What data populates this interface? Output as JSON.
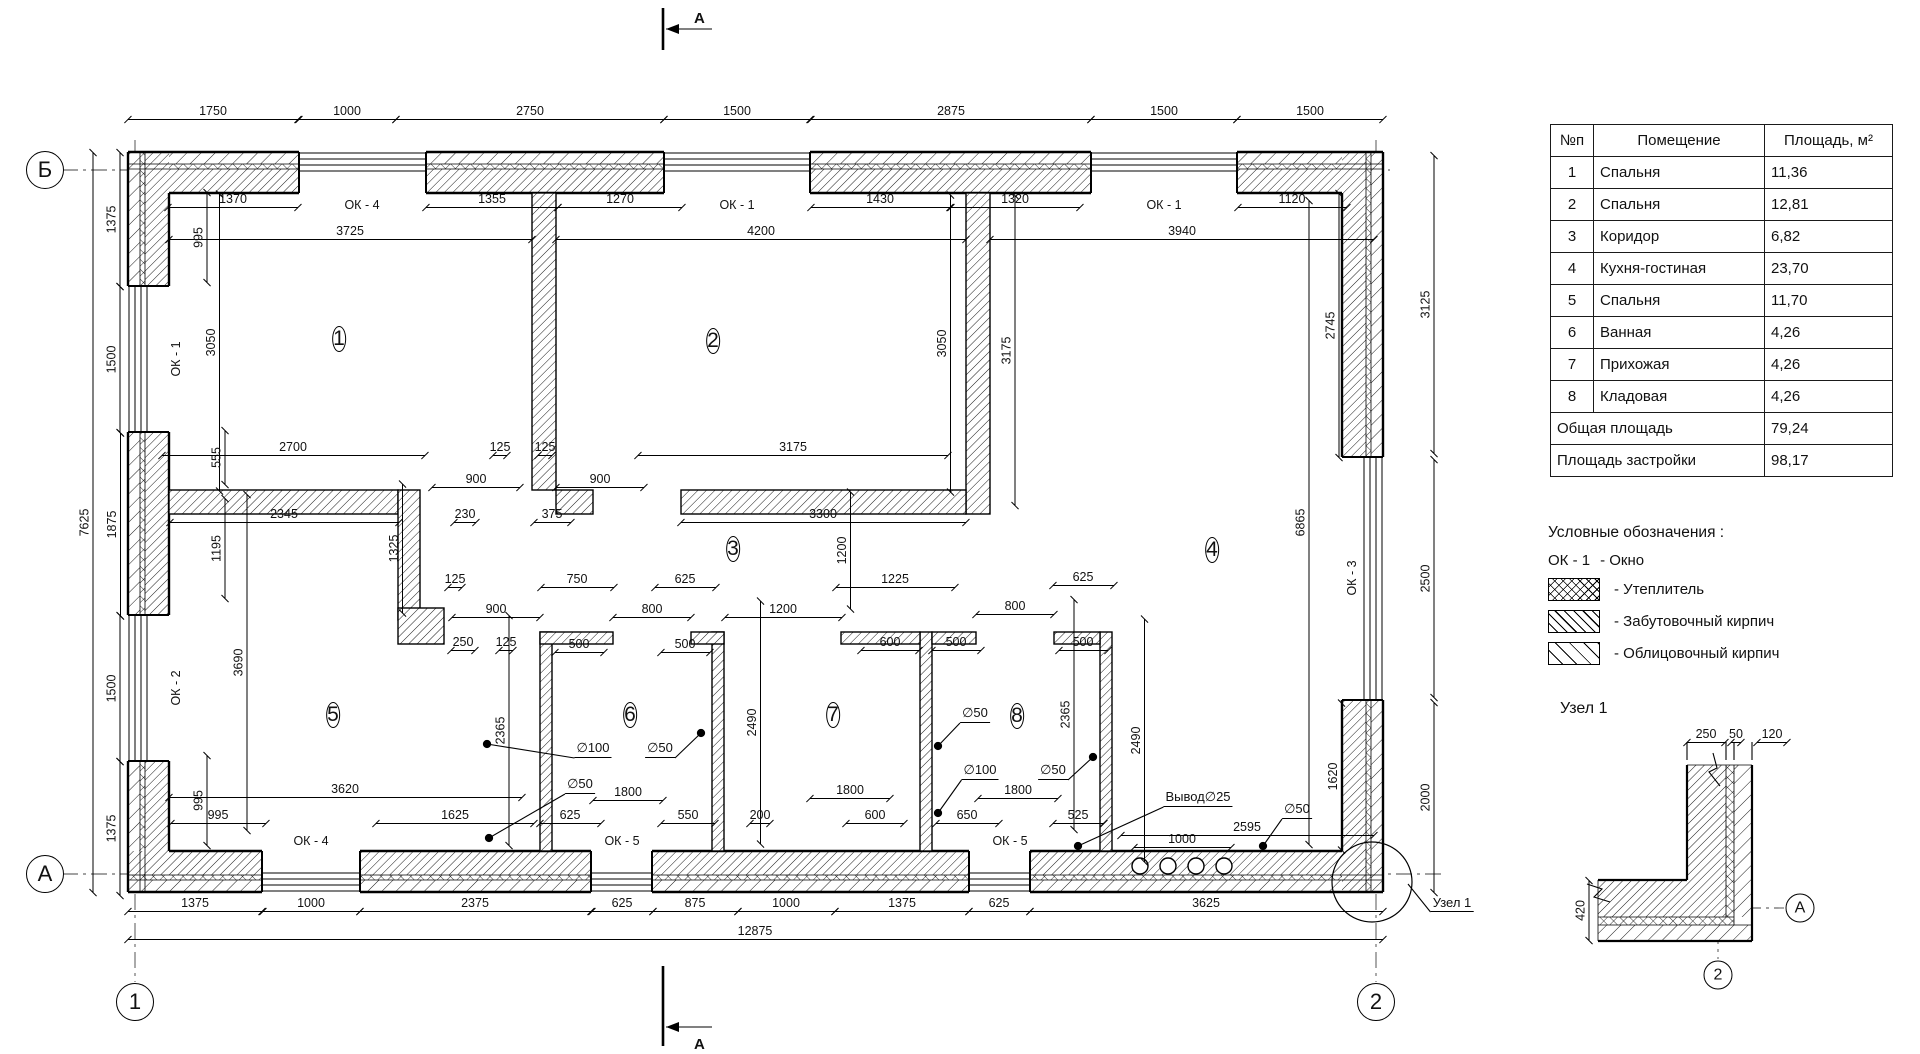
{
  "table": {
    "col_n": "№п",
    "col_room": "Помещение",
    "col_area": "Площадь, м²",
    "rows": [
      [
        "1",
        "Спальня",
        "11,36"
      ],
      [
        "2",
        "Спальня",
        "12,81"
      ],
      [
        "3",
        "Коридор",
        "6,82"
      ],
      [
        "4",
        "Кухня-гостиная",
        "23,70"
      ],
      [
        "5",
        "Спальня",
        "11,70"
      ],
      [
        "6",
        "Ванная",
        "4,26"
      ],
      [
        "7",
        "Прихожая",
        "4,26"
      ],
      [
        "8",
        "Кладовая",
        "4,26"
      ]
    ],
    "total_label": "Общая площадь",
    "total_value": "79,24",
    "footprint_label": "Площадь застройки",
    "footprint_value": "98,17"
  },
  "legend": {
    "header": "Условные обозначения :",
    "items": [
      {
        "key": "ОК - 1",
        "label": "- Окно",
        "pattern": "none"
      },
      {
        "key": "",
        "label": "- Утеплитель",
        "pattern": "insulation"
      },
      {
        "key": "",
        "label": "- Забутовочный кирпич",
        "pattern": "backing-brick"
      },
      {
        "key": "",
        "label": "- Облицовочный кирпич",
        "pattern": "facing-brick"
      }
    ]
  },
  "detail": {
    "title": "Узел 1"
  },
  "plan": {
    "section_label": "А",
    "rooms": [
      [
        "1",
        339,
        339
      ],
      [
        "2",
        713,
        341
      ],
      [
        "3",
        733,
        549
      ],
      [
        "4",
        1212,
        550
      ],
      [
        "5",
        333,
        715
      ],
      [
        "6",
        630,
        715
      ],
      [
        "7",
        833,
        715
      ],
      [
        "8",
        1017,
        716
      ]
    ],
    "axes": [
      [
        "Б",
        45,
        170,
        36
      ],
      [
        "А",
        45,
        874,
        36
      ],
      [
        "1",
        135,
        1002,
        36
      ],
      [
        "2",
        1376,
        1002,
        36
      ],
      [
        "А",
        1800,
        908,
        27
      ],
      [
        "2",
        1718,
        975,
        27
      ]
    ],
    "window_tags": [
      [
        "ОК - 4",
        362,
        205,
        0
      ],
      [
        "ОК - 1",
        737,
        205,
        0
      ],
      [
        "ОК - 1",
        1164,
        205,
        0
      ],
      [
        "ОК - 1",
        176,
        359,
        1
      ],
      [
        "ОК - 2",
        176,
        688,
        1
      ],
      [
        "ОК - 3",
        1352,
        578,
        1
      ],
      [
        "ОК - 4",
        311,
        841,
        0
      ],
      [
        "ОК - 5",
        622,
        841,
        0
      ],
      [
        "ОК - 5",
        1010,
        841,
        0
      ]
    ],
    "dims": [
      [
        "1750",
        213,
        112,
        0,
        171
      ],
      [
        "1000",
        347,
        112,
        0,
        98
      ],
      [
        "2750",
        530,
        112,
        0,
        268
      ],
      [
        "1500",
        737,
        112,
        0,
        146
      ],
      [
        "2875",
        951,
        112,
        0,
        280
      ],
      [
        "1500",
        1164,
        112,
        0,
        146
      ],
      [
        "1500",
        1310,
        112,
        0,
        146
      ],
      [
        "1370",
        233,
        200,
        0,
        130
      ],
      [
        "1355",
        492,
        200,
        0,
        132
      ],
      [
        "1270",
        620,
        200,
        0,
        124
      ],
      [
        "1430",
        880,
        200,
        0,
        139
      ],
      [
        "1320",
        1015,
        200,
        0,
        129
      ],
      [
        "1120",
        1292,
        200,
        0,
        109
      ],
      [
        "3725",
        350,
        232,
        0,
        363
      ],
      [
        "4200",
        761,
        232,
        0,
        410
      ],
      [
        "3940",
        1182,
        232,
        0,
        384
      ],
      [
        "7625",
        86,
        522,
        1,
        740
      ],
      [
        "1375",
        113,
        219,
        1,
        134
      ],
      [
        "1500",
        113,
        359,
        1,
        146
      ],
      [
        "1875",
        113,
        524,
        1,
        183
      ],
      [
        "1500",
        113,
        688,
        1,
        146
      ],
      [
        "1375",
        113,
        828,
        1,
        134
      ],
      [
        "995",
        200,
        237,
        1,
        90
      ],
      [
        "3050",
        212,
        342,
        1,
        297
      ],
      [
        "555",
        218,
        457,
        1,
        54
      ],
      [
        "1195",
        218,
        548,
        1,
        100
      ],
      [
        "3690",
        240,
        662,
        1,
        336
      ],
      [
        "995",
        200,
        800,
        1,
        90
      ],
      [
        "1325",
        395,
        548,
        1,
        129
      ],
      [
        "2700",
        293,
        448,
        0,
        263
      ],
      [
        "125",
        500,
        448,
        0,
        14
      ],
      [
        "125",
        545,
        448,
        0,
        14
      ],
      [
        "3175",
        793,
        448,
        0,
        310
      ],
      [
        "900",
        476,
        480,
        0,
        88
      ],
      [
        "900",
        600,
        480,
        0,
        88
      ],
      [
        "2345",
        284,
        515,
        0,
        229
      ],
      [
        "230",
        465,
        515,
        0,
        22
      ],
      [
        "375",
        552,
        515,
        0,
        37
      ],
      [
        "3300",
        823,
        515,
        0,
        285
      ],
      [
        "3050",
        943,
        343,
        1,
        297
      ],
      [
        "3175",
        1008,
        350,
        1,
        310
      ],
      [
        "1200",
        843,
        550,
        1,
        117
      ],
      [
        "125",
        455,
        580,
        0,
        14
      ],
      [
        "750",
        577,
        580,
        0,
        73
      ],
      [
        "625",
        685,
        580,
        0,
        61
      ],
      [
        "1225",
        895,
        580,
        0,
        119
      ],
      [
        "625",
        1083,
        578,
        0,
        61
      ],
      [
        "900",
        496,
        610,
        0,
        88
      ],
      [
        "800",
        652,
        610,
        0,
        78
      ],
      [
        "1200",
        783,
        610,
        0,
        117
      ],
      [
        "800",
        1015,
        607,
        0,
        78
      ],
      [
        "250",
        463,
        643,
        0,
        24
      ],
      [
        "125",
        506,
        643,
        0,
        14
      ],
      [
        "500",
        579,
        645,
        0,
        49
      ],
      [
        "500",
        685,
        645,
        0,
        49
      ],
      [
        "600",
        890,
        643,
        0,
        58
      ],
      [
        "500",
        956,
        643,
        0,
        49
      ],
      [
        "500",
        1083,
        643,
        0,
        49
      ],
      [
        "2365",
        502,
        730,
        1,
        230
      ],
      [
        "2490",
        753,
        722,
        1,
        243
      ],
      [
        "2365",
        1067,
        714,
        1,
        230
      ],
      [
        "2490",
        1137,
        740,
        1,
        243
      ],
      [
        "3620",
        345,
        790,
        0,
        353
      ],
      [
        "1800",
        628,
        793,
        0,
        70
      ],
      [
        "1800",
        850,
        791,
        0,
        80
      ],
      [
        "1800",
        1018,
        791,
        0,
        80
      ],
      [
        "995",
        218,
        816,
        0,
        95
      ],
      [
        "1625",
        455,
        816,
        0,
        158
      ],
      [
        "625",
        570,
        816,
        0,
        61
      ],
      [
        "550",
        688,
        816,
        0,
        54
      ],
      [
        "200",
        760,
        816,
        0,
        20
      ],
      [
        "600",
        875,
        816,
        0,
        58
      ],
      [
        "650",
        967,
        816,
        0,
        63
      ],
      [
        "525",
        1078,
        816,
        0,
        51
      ],
      [
        "1000",
        1182,
        840,
        0,
        97
      ],
      [
        "2595",
        1247,
        828,
        0,
        253
      ],
      [
        "2745",
        1332,
        325,
        1,
        264
      ],
      [
        "3125",
        1427,
        304,
        1,
        298
      ],
      [
        "2500",
        1427,
        578,
        1,
        238
      ],
      [
        "6865",
        1302,
        522,
        1,
        644
      ],
      [
        "1620",
        1334,
        776,
        1,
        147
      ],
      [
        "2000",
        1427,
        797,
        1,
        190
      ],
      [
        "1375",
        195,
        904,
        0,
        134
      ],
      [
        "1000",
        311,
        904,
        0,
        97
      ],
      [
        "2375",
        475,
        904,
        0,
        231
      ],
      [
        "625",
        622,
        904,
        0,
        61
      ],
      [
        "875",
        695,
        904,
        0,
        85
      ],
      [
        "1000",
        786,
        904,
        0,
        97
      ],
      [
        "1375",
        902,
        904,
        0,
        134
      ],
      [
        "625",
        999,
        904,
        0,
        61
      ],
      [
        "3625",
        1206,
        904,
        0,
        353
      ],
      [
        "12875",
        755,
        932,
        0,
        1255
      ],
      [
        "250",
        1706,
        735,
        0,
        38
      ],
      [
        "50",
        1736,
        735,
        0,
        10
      ],
      [
        "120",
        1772,
        735,
        0,
        30
      ],
      [
        "420",
        1582,
        910,
        1,
        60
      ]
    ],
    "leaders": [
      [
        "∅100",
        593,
        750,
        487,
        744,
        1
      ],
      [
        "∅50",
        660,
        750,
        701,
        733,
        1
      ],
      [
        "∅50",
        580,
        786,
        489,
        838,
        1
      ],
      [
        "∅50",
        975,
        715,
        938,
        746,
        1
      ],
      [
        "∅100",
        980,
        772,
        938,
        813,
        1
      ],
      [
        "∅50",
        1053,
        772,
        1093,
        757,
        1
      ],
      [
        "Вывод∅25",
        1198,
        799,
        1078,
        846,
        1
      ],
      [
        "∅50",
        1297,
        811,
        1263,
        846,
        1
      ],
      [
        "Узел 1",
        1452,
        904,
        1408,
        884,
        0
      ]
    ]
  }
}
